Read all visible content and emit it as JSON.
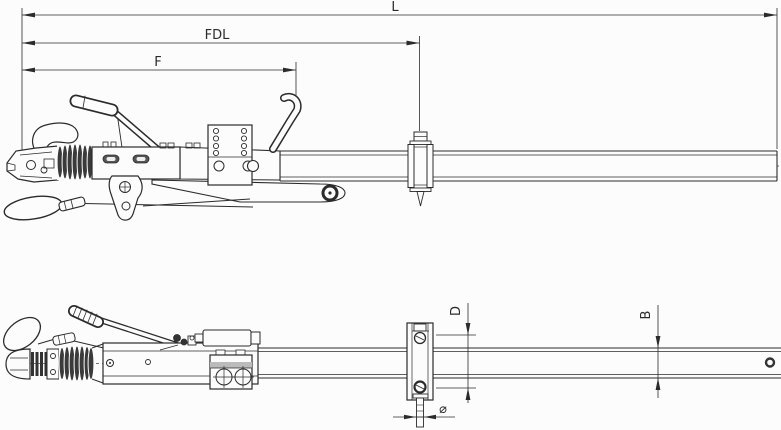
{
  "drawing": {
    "background": "#fcfcfc",
    "line_color": "#2b2b2b",
    "dark_fill": "#3a3a3a",
    "band_fill": "#bbbbbb"
  },
  "dimensions": {
    "overall_length": {
      "label": "L"
    },
    "fdl_length": {
      "label": "FDL"
    },
    "f_length": {
      "label": "F"
    },
    "bracket_hole_spacing": {
      "label": "D"
    },
    "tube_height": {
      "label": "B"
    },
    "bolt_diameter": {
      "label": "⌀"
    }
  }
}
